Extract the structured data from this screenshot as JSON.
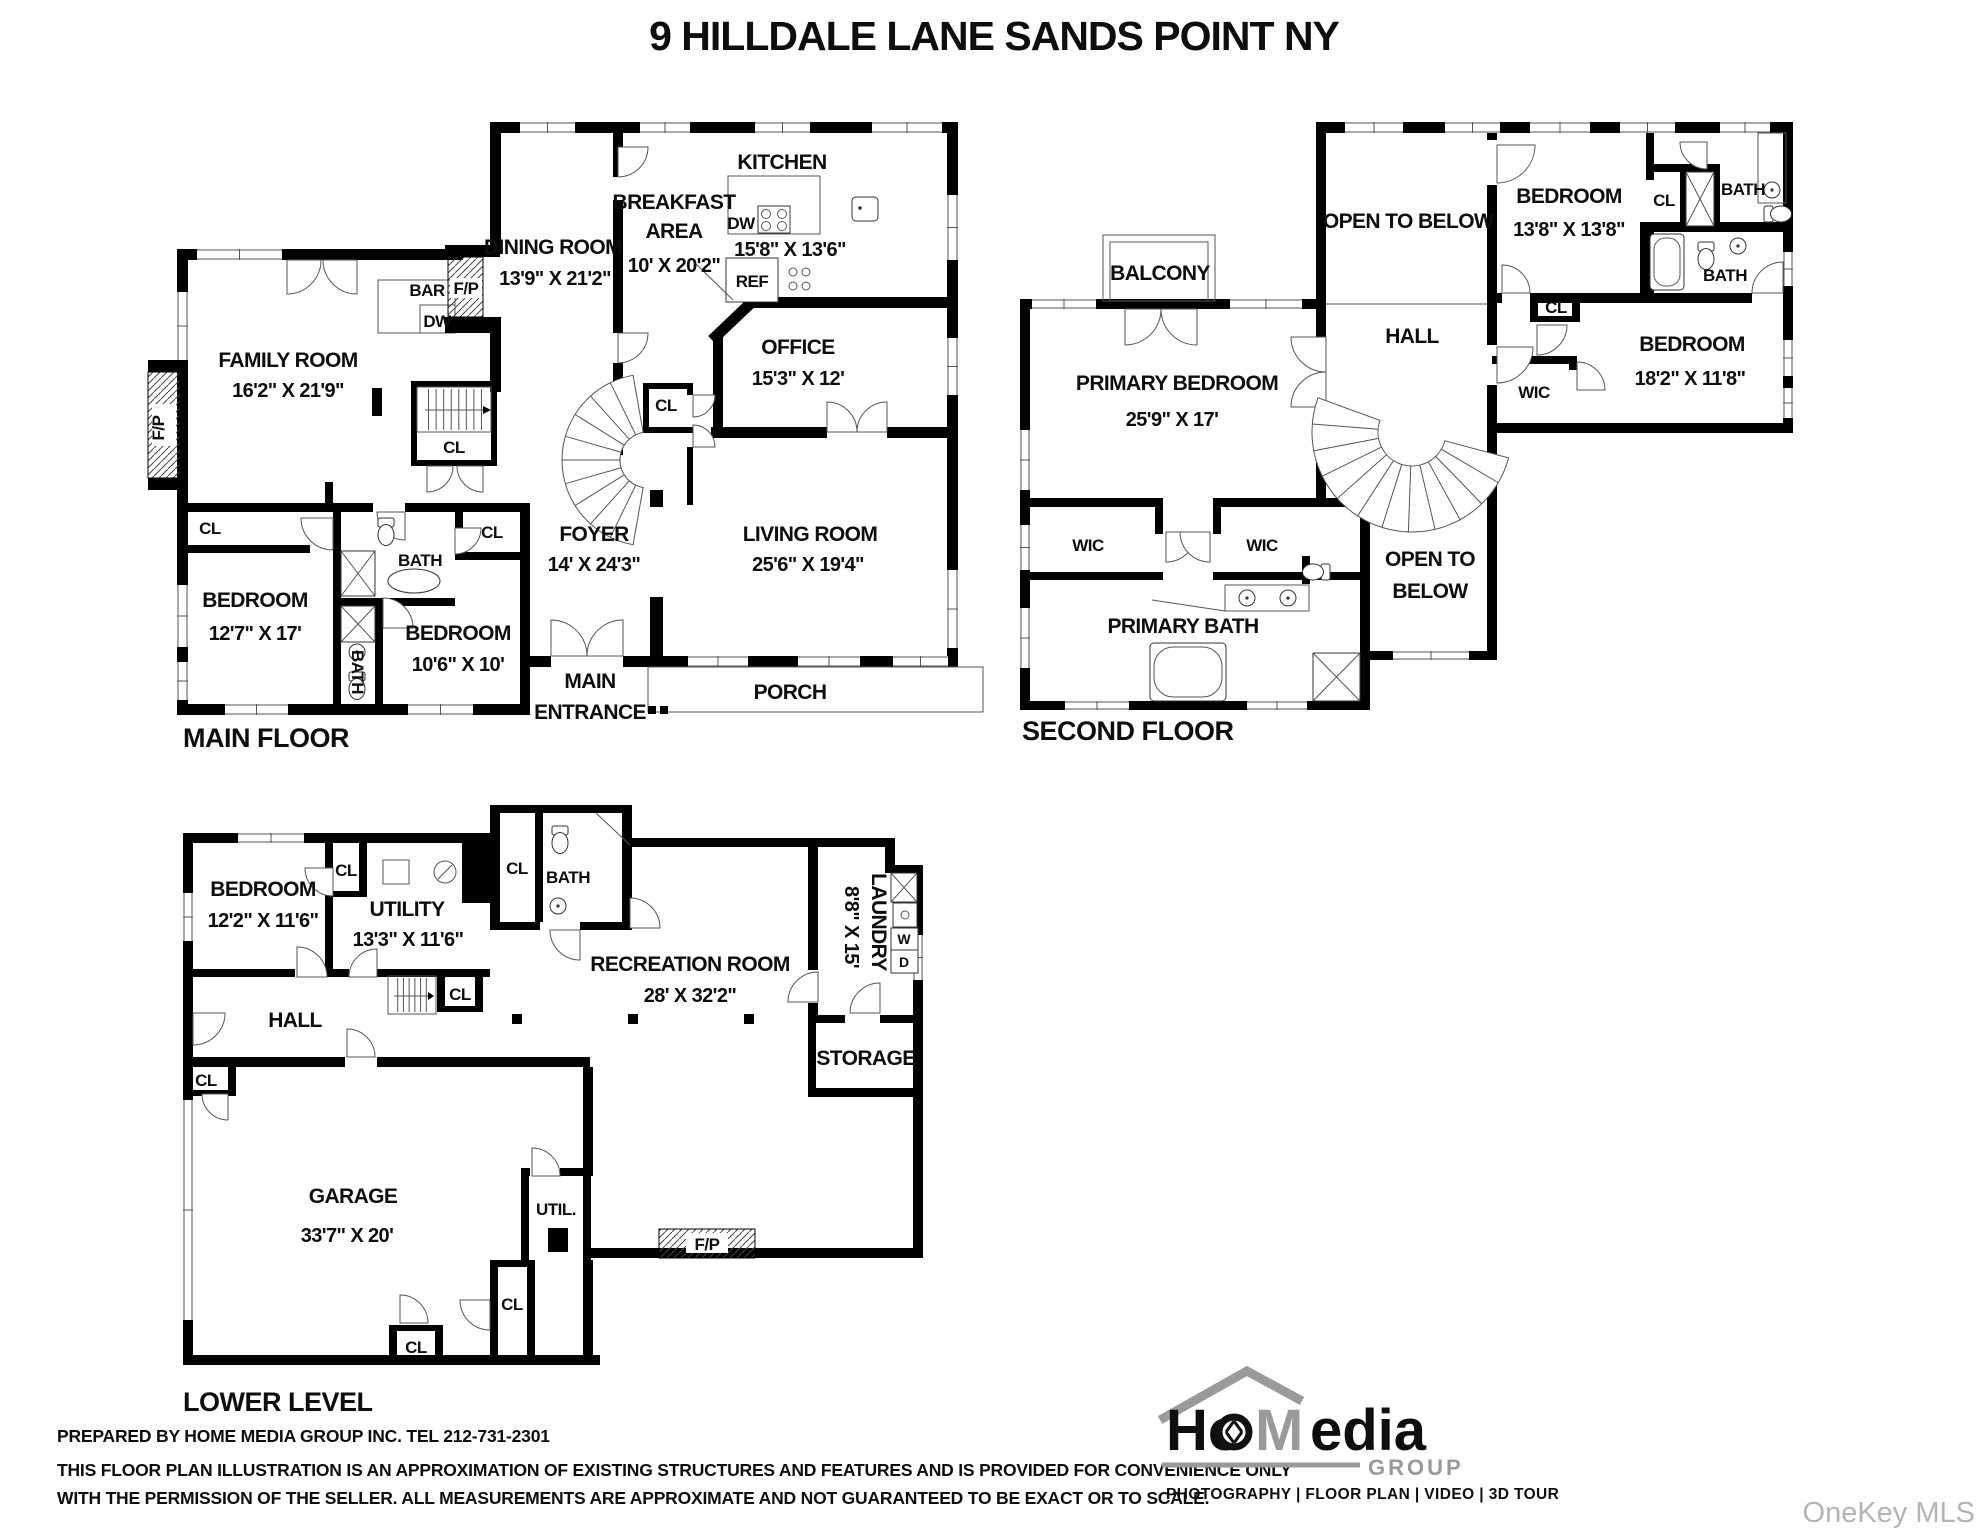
{
  "title": "9 HILLDALE LANE SANDS POINT NY",
  "floors": {
    "main": {
      "name": "MAIN FLOOR",
      "rooms": {
        "family_room": {
          "name": "FAMILY ROOM",
          "dims": "16'2\" X 21'9\""
        },
        "dining_room": {
          "name": "DINING ROOM",
          "dims": "13'9\" X 21'2\""
        },
        "breakfast_area": {
          "name1": "BREAKFAST",
          "name2": "AREA",
          "dims": "10' X 20'2\""
        },
        "kitchen": {
          "name": "KITCHEN",
          "dims": "15'8\" X 13'6\""
        },
        "office": {
          "name": "OFFICE",
          "dims": "15'3\" X 12'"
        },
        "foyer": {
          "name": "FOYER",
          "dims": "14' X 24'3\""
        },
        "living_room": {
          "name": "LIVING ROOM",
          "dims": "25'6\" X 19'4\""
        },
        "bedroom_1": {
          "name": "BEDROOM",
          "dims": "12'7\" X 17'"
        },
        "bedroom_2": {
          "name": "BEDROOM",
          "dims": "10'6\" X 10'"
        },
        "porch": {
          "name": "PORCH"
        },
        "main_entrance": {
          "name1": "MAIN",
          "name2": "ENTRANCE"
        }
      }
    },
    "second": {
      "name": "SECOND FLOOR",
      "rooms": {
        "primary_bedroom": {
          "name": "PRIMARY BEDROOM",
          "dims": "25'9\" X 17'"
        },
        "balcony": {
          "name": "BALCONY"
        },
        "open_to_below_top": {
          "name": "OPEN TO BELOW"
        },
        "open_to_below_bottom": {
          "name1": "OPEN TO",
          "name2": "BELOW"
        },
        "hall": {
          "name": "HALL"
        },
        "bedroom_3": {
          "name": "BEDROOM",
          "dims": "13'8\" X 13'8\""
        },
        "bedroom_4": {
          "name": "BEDROOM",
          "dims": "18'2\" X 11'8\""
        },
        "primary_bath": {
          "name": "PRIMARY BATH"
        }
      }
    },
    "lower": {
      "name": "LOWER LEVEL",
      "rooms": {
        "bedroom_5": {
          "name": "BEDROOM",
          "dims": "12'2\" X 11'6\""
        },
        "utility": {
          "name": "UTILITY",
          "dims": "13'3\" X 11'6\""
        },
        "recreation_room": {
          "name": "RECREATION ROOM",
          "dims": "28' X 32'2\""
        },
        "laundry": {
          "name": "LAUNDRY",
          "dims": "8'8\" X 15'"
        },
        "storage": {
          "name": "STORAGE"
        },
        "garage": {
          "name": "GARAGE",
          "dims": "33'7\" X 20'"
        },
        "hall": {
          "name": "HALL"
        }
      }
    }
  },
  "abbr": {
    "cl": "CL",
    "bath": "BATH",
    "bar": "BAR",
    "dw": "DW",
    "fp": "F/P",
    "ref": "REF",
    "wic": "WIC",
    "util": "UTIL.",
    "washer": "W",
    "dryer": "D"
  },
  "footer": {
    "line1": "PREPARED BY  HOME MEDIA GROUP INC.  TEL 212-731-2301",
    "line2": "THIS FLOOR PLAN ILLUSTRATION IS AN APPROXIMATION OF EXISTING STRUCTURES AND FEATURES AND IS PROVIDED FOR CONVENIENCE ONLY",
    "line3": "WITH THE PERMISSION OF THE SELLER. ALL MEASUREMENTS ARE APPROXIMATE AND NOT GUARANTEED TO BE EXACT OR TO SCALE."
  },
  "logo": {
    "brand_h": "Ho",
    "brand_m": "M",
    "brand_rest": "edia",
    "group": "GROUP",
    "tagline": "PHOTOGRAPHY | FLOOR PLAN | VIDEO | 3D TOUR"
  },
  "watermark": "OneKey MLS"
}
